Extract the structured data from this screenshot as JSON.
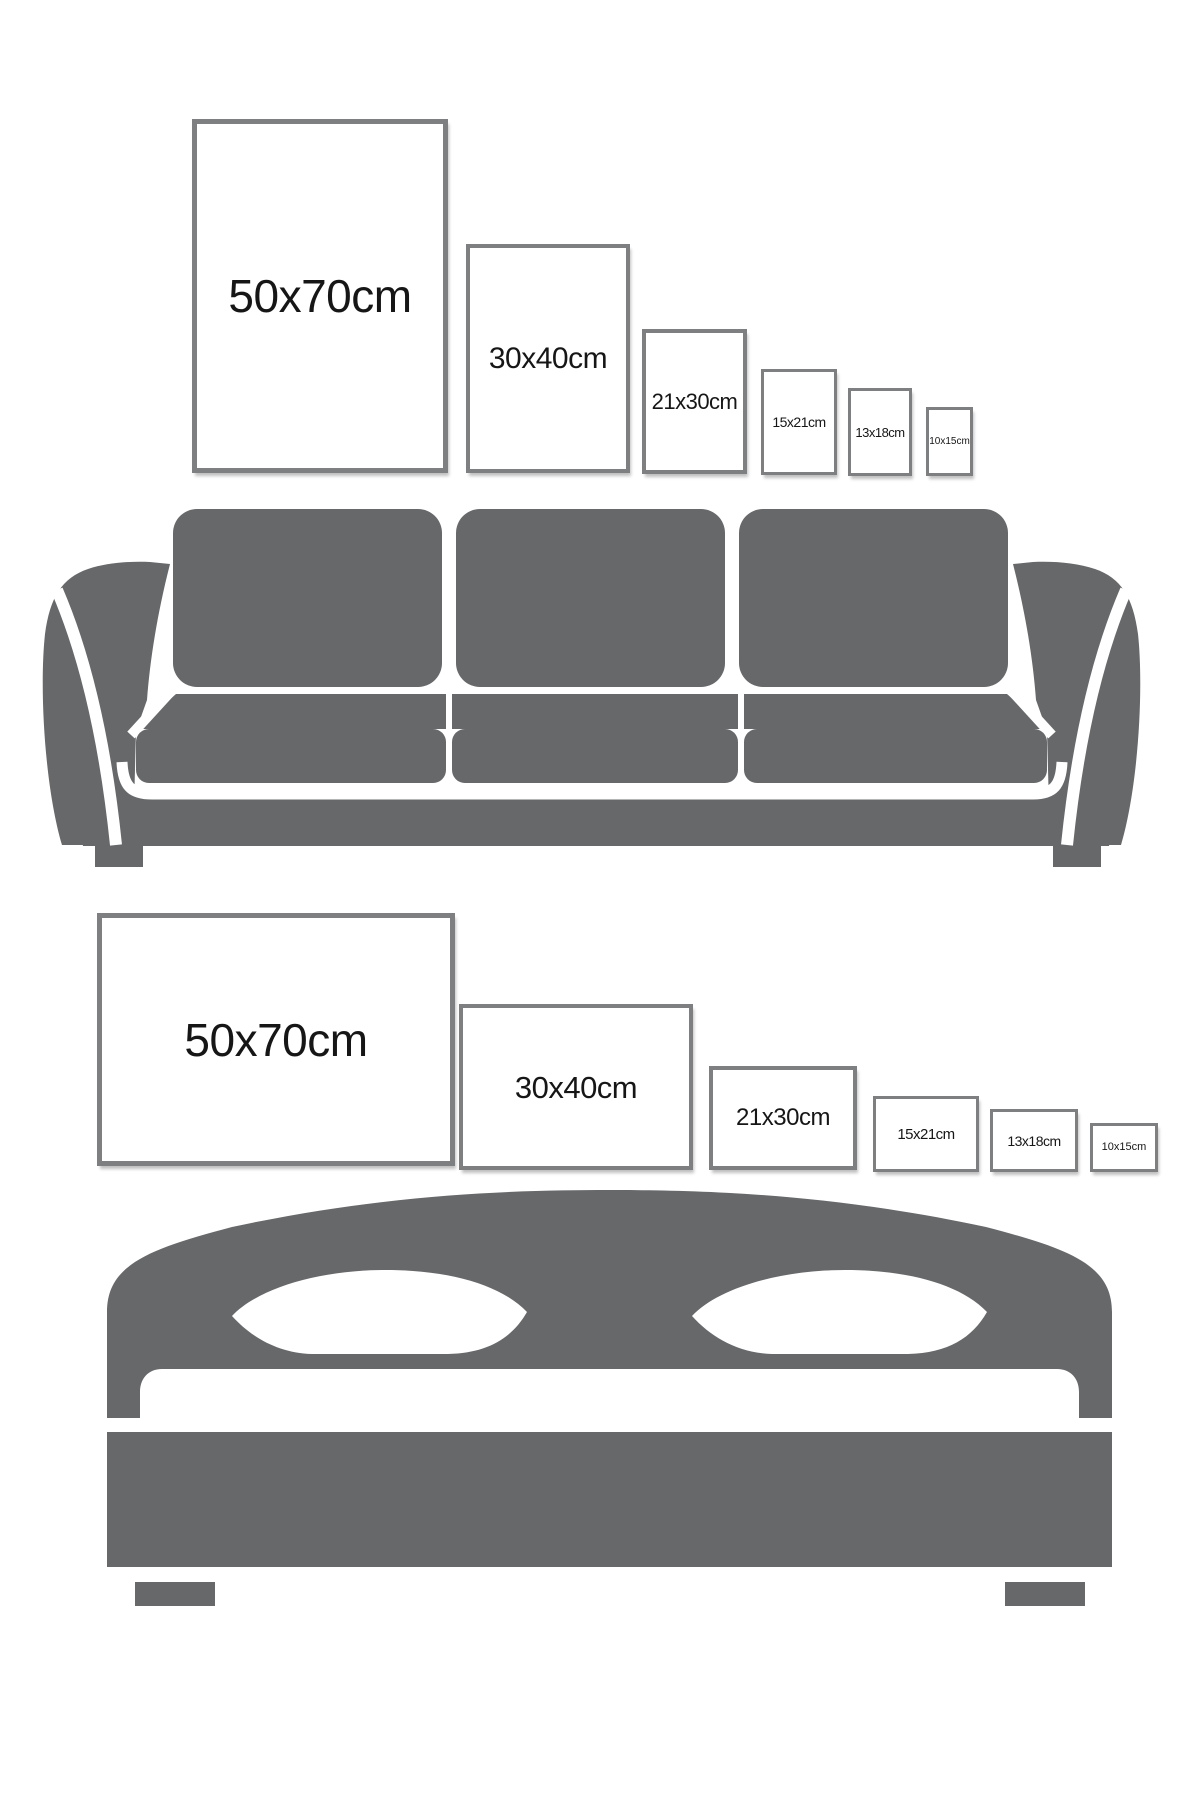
{
  "page": {
    "description": "Poster size comparison guide over sofa and bed silhouettes"
  },
  "colors": {
    "background": "#ffffff",
    "silhouette_gray": "#67686a",
    "frame_border_gray": "#7d7f80",
    "label_black": "#161616"
  },
  "sofa_wall": {
    "furniture": "sofa",
    "orientation": "portrait",
    "frames": [
      {
        "label": "50x70cm"
      },
      {
        "label": "30x40cm"
      },
      {
        "label": "21x30cm"
      },
      {
        "label": "15x21cm"
      },
      {
        "label": "13x18cm"
      },
      {
        "label": "10x15cm"
      }
    ]
  },
  "bed_wall": {
    "furniture": "bed",
    "orientation": "landscape",
    "frames": [
      {
        "label": "50x70cm"
      },
      {
        "label": "30x40cm"
      },
      {
        "label": "21x30cm"
      },
      {
        "label": "15x21cm"
      },
      {
        "label": "13x18cm"
      },
      {
        "label": "10x15cm"
      }
    ]
  }
}
